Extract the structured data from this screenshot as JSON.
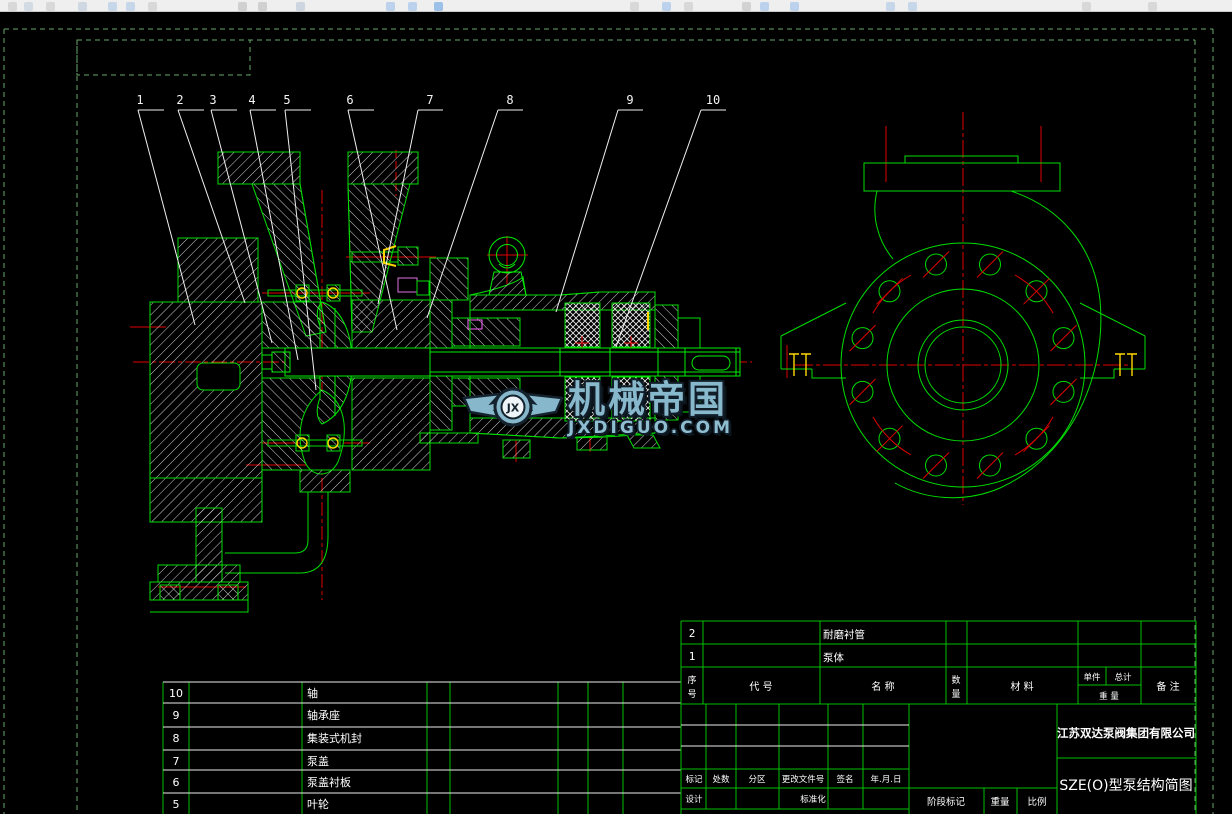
{
  "callouts": {
    "labels": [
      "1",
      "2",
      "3",
      "4",
      "5",
      "6",
      "7",
      "8",
      "9",
      "10"
    ]
  },
  "watermark": {
    "logo_text": "JX",
    "title": "机械帝国",
    "url": "JXDIGUO.COM"
  },
  "parts_list": {
    "rows": [
      {
        "no": "10",
        "name": "轴"
      },
      {
        "no": "9",
        "name": "轴承座"
      },
      {
        "no": "8",
        "name": "集装式机封"
      },
      {
        "no": "7",
        "name": "泵盖"
      },
      {
        "no": "6",
        "name": "泵盖衬板"
      },
      {
        "no": "5",
        "name": "叶轮"
      }
    ]
  },
  "title_block": {
    "item_rows": [
      {
        "no": "2",
        "name": "耐磨衬管"
      },
      {
        "no": "1",
        "name": "泵体"
      }
    ],
    "headers": {
      "seq_top": "序",
      "seq_bottom": "号",
      "code": "代  号",
      "name": "名  称",
      "qty_top": "数",
      "qty_bottom": "量",
      "material": "材  料",
      "unit": "单件",
      "total": "总计",
      "weight": "重 量",
      "remarks": "备 注"
    },
    "revision": {
      "cols": [
        "标记",
        "处数",
        "分区",
        "更改文件号",
        "签名",
        "年.月.日"
      ],
      "design": "设计",
      "standardization": "标准化"
    },
    "stage": {
      "stage_mark": "阶段标记",
      "weight": "重量",
      "scale": "比例"
    },
    "company": "江苏双达泵阀集团有限公司",
    "drawing_title": "SZE(O)型泵结构简图"
  }
}
